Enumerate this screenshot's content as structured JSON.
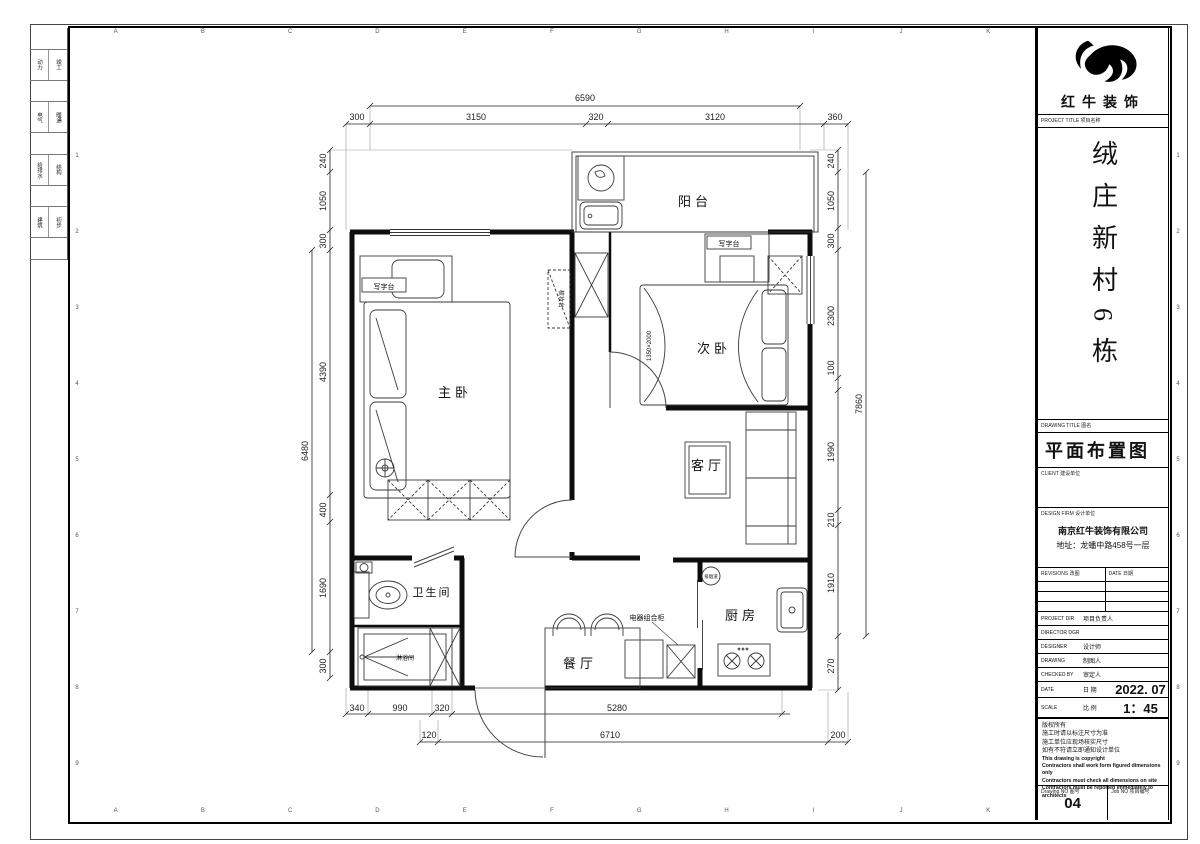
{
  "sheet": {
    "grid_letters": [
      "A",
      "B",
      "C",
      "D",
      "E",
      "F",
      "G",
      "H",
      "I",
      "J",
      "K"
    ],
    "grid_numbers": [
      "1",
      "2",
      "3",
      "4",
      "5",
      "6",
      "7",
      "8",
      "9"
    ],
    "edge_strip": {
      "rows": [
        [
          "动力",
          "竣工"
        ],
        [
          "电气",
          "暖通"
        ],
        [
          "给排水",
          "结构"
        ],
        [
          "建筑",
          "初步"
        ]
      ]
    }
  },
  "title_block": {
    "brand": "红牛装饰",
    "project_label": "PROJECT TITLE  项目名称",
    "project_title": "绒庄新村6栋",
    "drawing_label": "DRAWING TITLE  图名",
    "drawing_title": "平面布置图",
    "client_label": "CLIENT  建设单位",
    "firm_label": "DESIGN FIRM  设计单位",
    "firm_name": "南京红牛装饰有限公司",
    "firm_address": "地址：龙蟠中路458号一层",
    "revisions_label": "REVISIONS  改图",
    "rev_date_label": "DATE  日期",
    "rows": [
      {
        "en": "PROJECT DIR",
        "cn": "项目负责人",
        "value": ""
      },
      {
        "en": "DIRECTOR DGR",
        "cn": "",
        "value": ""
      },
      {
        "en": "DESIGNER",
        "cn": "设计师",
        "value": ""
      },
      {
        "en": "DRAWING",
        "cn": "制图人",
        "value": ""
      },
      {
        "en": "CHECKED BY",
        "cn": "审定人",
        "value": ""
      },
      {
        "en": "DATE",
        "cn": "日 期",
        "value": "2022. 07"
      },
      {
        "en": "SCALE",
        "cn": "比 例",
        "value": "1：45"
      }
    ],
    "notes": [
      "版权所有",
      "施工时请以标注尺寸为准",
      "施工单位应现场核实尺寸",
      "如有不符请立即通知设计单位",
      "This drawing is copyright",
      "Contractors shall work form figured dimensions only",
      "Contractors must check all dimensions on site",
      "Contractors must be reported immediately to architects"
    ],
    "drawing_no_label": "Drawing NO  图号",
    "drawing_no": "04",
    "job_no_label": "Job NO  项目编号",
    "job_no": ""
  },
  "plan": {
    "rooms": {
      "balcony": "阳台",
      "second_bedroom": "次卧",
      "master_bedroom": "主卧",
      "living_room": "客厅",
      "bathroom": "卫生间",
      "shower_room": "淋浴间",
      "dining_room": "餐厅",
      "kitchen": "厨房"
    },
    "labels": {
      "desk_balcony": "写字台",
      "desk_master": "写字台",
      "dresser": "梳妆台",
      "appliance_cabinet": "电器组合柜",
      "bed_size": "1350×2000",
      "flue": "排烟道"
    },
    "dims": {
      "top_total": "6590",
      "top": [
        "300",
        "3150",
        "320",
        "3120",
        "360"
      ],
      "left": [
        "240",
        "1050",
        "300",
        "4390",
        "400",
        "1690",
        "300"
      ],
      "left_total": "6480",
      "right": [
        "240",
        "1050",
        "300",
        "2300",
        "100",
        "1990",
        "210",
        "1910",
        "270"
      ],
      "right_total": "7860",
      "bottom_row1": [
        "340",
        "990",
        "320",
        "5280"
      ],
      "bottom_row2": [
        "120",
        "6710",
        "200"
      ]
    }
  }
}
